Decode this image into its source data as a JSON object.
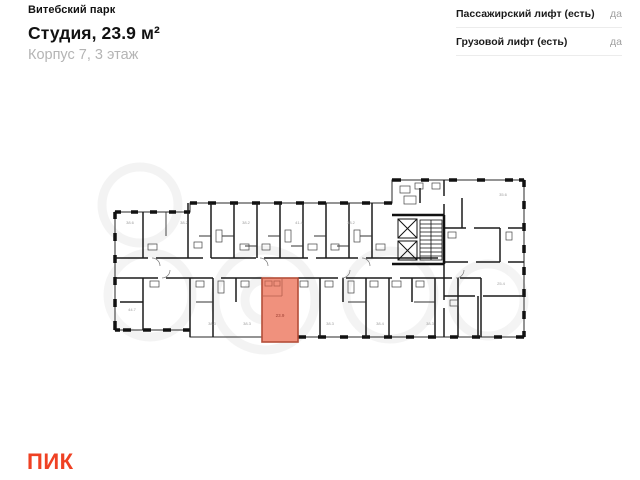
{
  "header": {
    "project_name": "Витебский парк",
    "title": "Студия, 23.9 м²",
    "subtitle": "Корпус 7, 3 этаж"
  },
  "attributes": {
    "rows": [
      {
        "label": "Пассажирский лифт (есть)",
        "value": "да"
      },
      {
        "label": "Грузовой лифт (есть)",
        "value": "да"
      }
    ]
  },
  "floorplan": {
    "wall_color": "#1b1b1b",
    "highlight": {
      "label": "23.9",
      "fill": "#f0917d",
      "border": "#b44e38",
      "label_color": "#9e4033"
    },
    "room_label_color": "#9d9d9d",
    "room_labels": [
      {
        "x": 130,
        "y": 224,
        "text": "38.6"
      },
      {
        "x": 184,
        "y": 224,
        "text": "38.2"
      },
      {
        "x": 246,
        "y": 224,
        "text": "38.2"
      },
      {
        "x": 299,
        "y": 224,
        "text": "41.4"
      },
      {
        "x": 351,
        "y": 224,
        "text": "38.2"
      },
      {
        "x": 503,
        "y": 196,
        "text": "35.6"
      },
      {
        "x": 501,
        "y": 285,
        "text": "25.4"
      },
      {
        "x": 132,
        "y": 311,
        "text": "44.7"
      },
      {
        "x": 212,
        "y": 325,
        "text": "38.3"
      },
      {
        "x": 247,
        "y": 325,
        "text": "38.3"
      },
      {
        "x": 330,
        "y": 325,
        "text": "38.3"
      },
      {
        "x": 380,
        "y": 325,
        "text": "38.4"
      },
      {
        "x": 430,
        "y": 325,
        "text": "38.3"
      }
    ]
  },
  "footer": {
    "logo_text": "ПИК",
    "logo_color": "#ef4123"
  }
}
